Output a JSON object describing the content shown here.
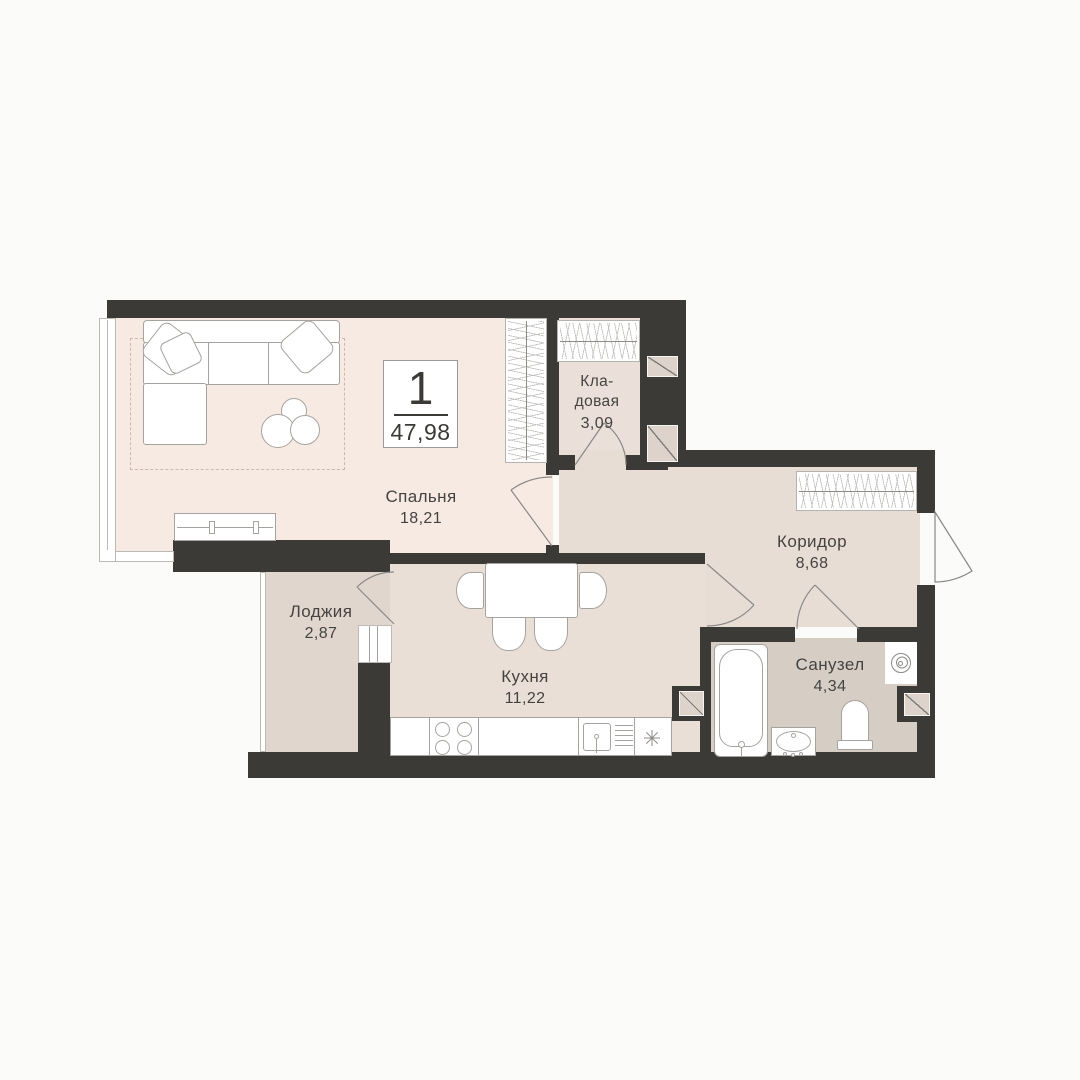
{
  "apartment": {
    "rooms_badge": "1",
    "total_area": "47,98"
  },
  "rooms": {
    "bedroom": {
      "name": "Спальня",
      "area": "18,21"
    },
    "storage": {
      "lines": [
        "Кла-",
        "довая"
      ],
      "area": "3,09"
    },
    "corridor": {
      "name": "Коридор",
      "area": "8,68"
    },
    "kitchen": {
      "name": "Кухня",
      "area": "11,22"
    },
    "loggia": {
      "name": "Лоджия",
      "area": "2,87"
    },
    "bathroom": {
      "name": "Санузел",
      "area": "4,34"
    }
  },
  "colors": {
    "wall": "#3b3a37",
    "bg": "#fbfbfa",
    "bedroom": "#f6eae3",
    "storage": "#eae0d9",
    "corridor": "#e7ddd5",
    "kitchen": "#eadfd7",
    "loggia": "#e0d6ce",
    "bathroom": "#d6cdc5",
    "text": "#45433f"
  }
}
